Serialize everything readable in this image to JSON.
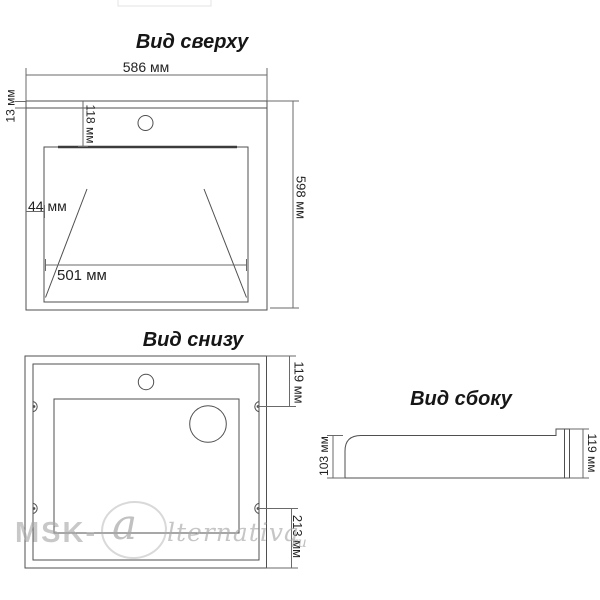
{
  "views": {
    "top": {
      "title": "Вид сверху",
      "dim_width": "586 мм",
      "dim_rim": "13 мм",
      "dim_faucet_offset": "118 мм",
      "dim_side_gap": "44 мм",
      "dim_bowl_width": "501 мм",
      "dim_height": "598 мм"
    },
    "bottom": {
      "title": "Вид снизу",
      "dim_hole_top": "119 мм",
      "dim_hole_bottom": "213 мм"
    },
    "side": {
      "title": "Вид сбоку",
      "dim_front_height": "103 мм",
      "dim_back_height": "119 мм"
    }
  },
  "watermark": {
    "prefix": "MSK-",
    "initial": "a",
    "rest": "lternativa",
    "tld": "ru"
  },
  "colors": {
    "line": "#4f4f4f",
    "dim_line": "#6a6a6a",
    "text": "#232323",
    "watermark": "#a8a8a8"
  }
}
